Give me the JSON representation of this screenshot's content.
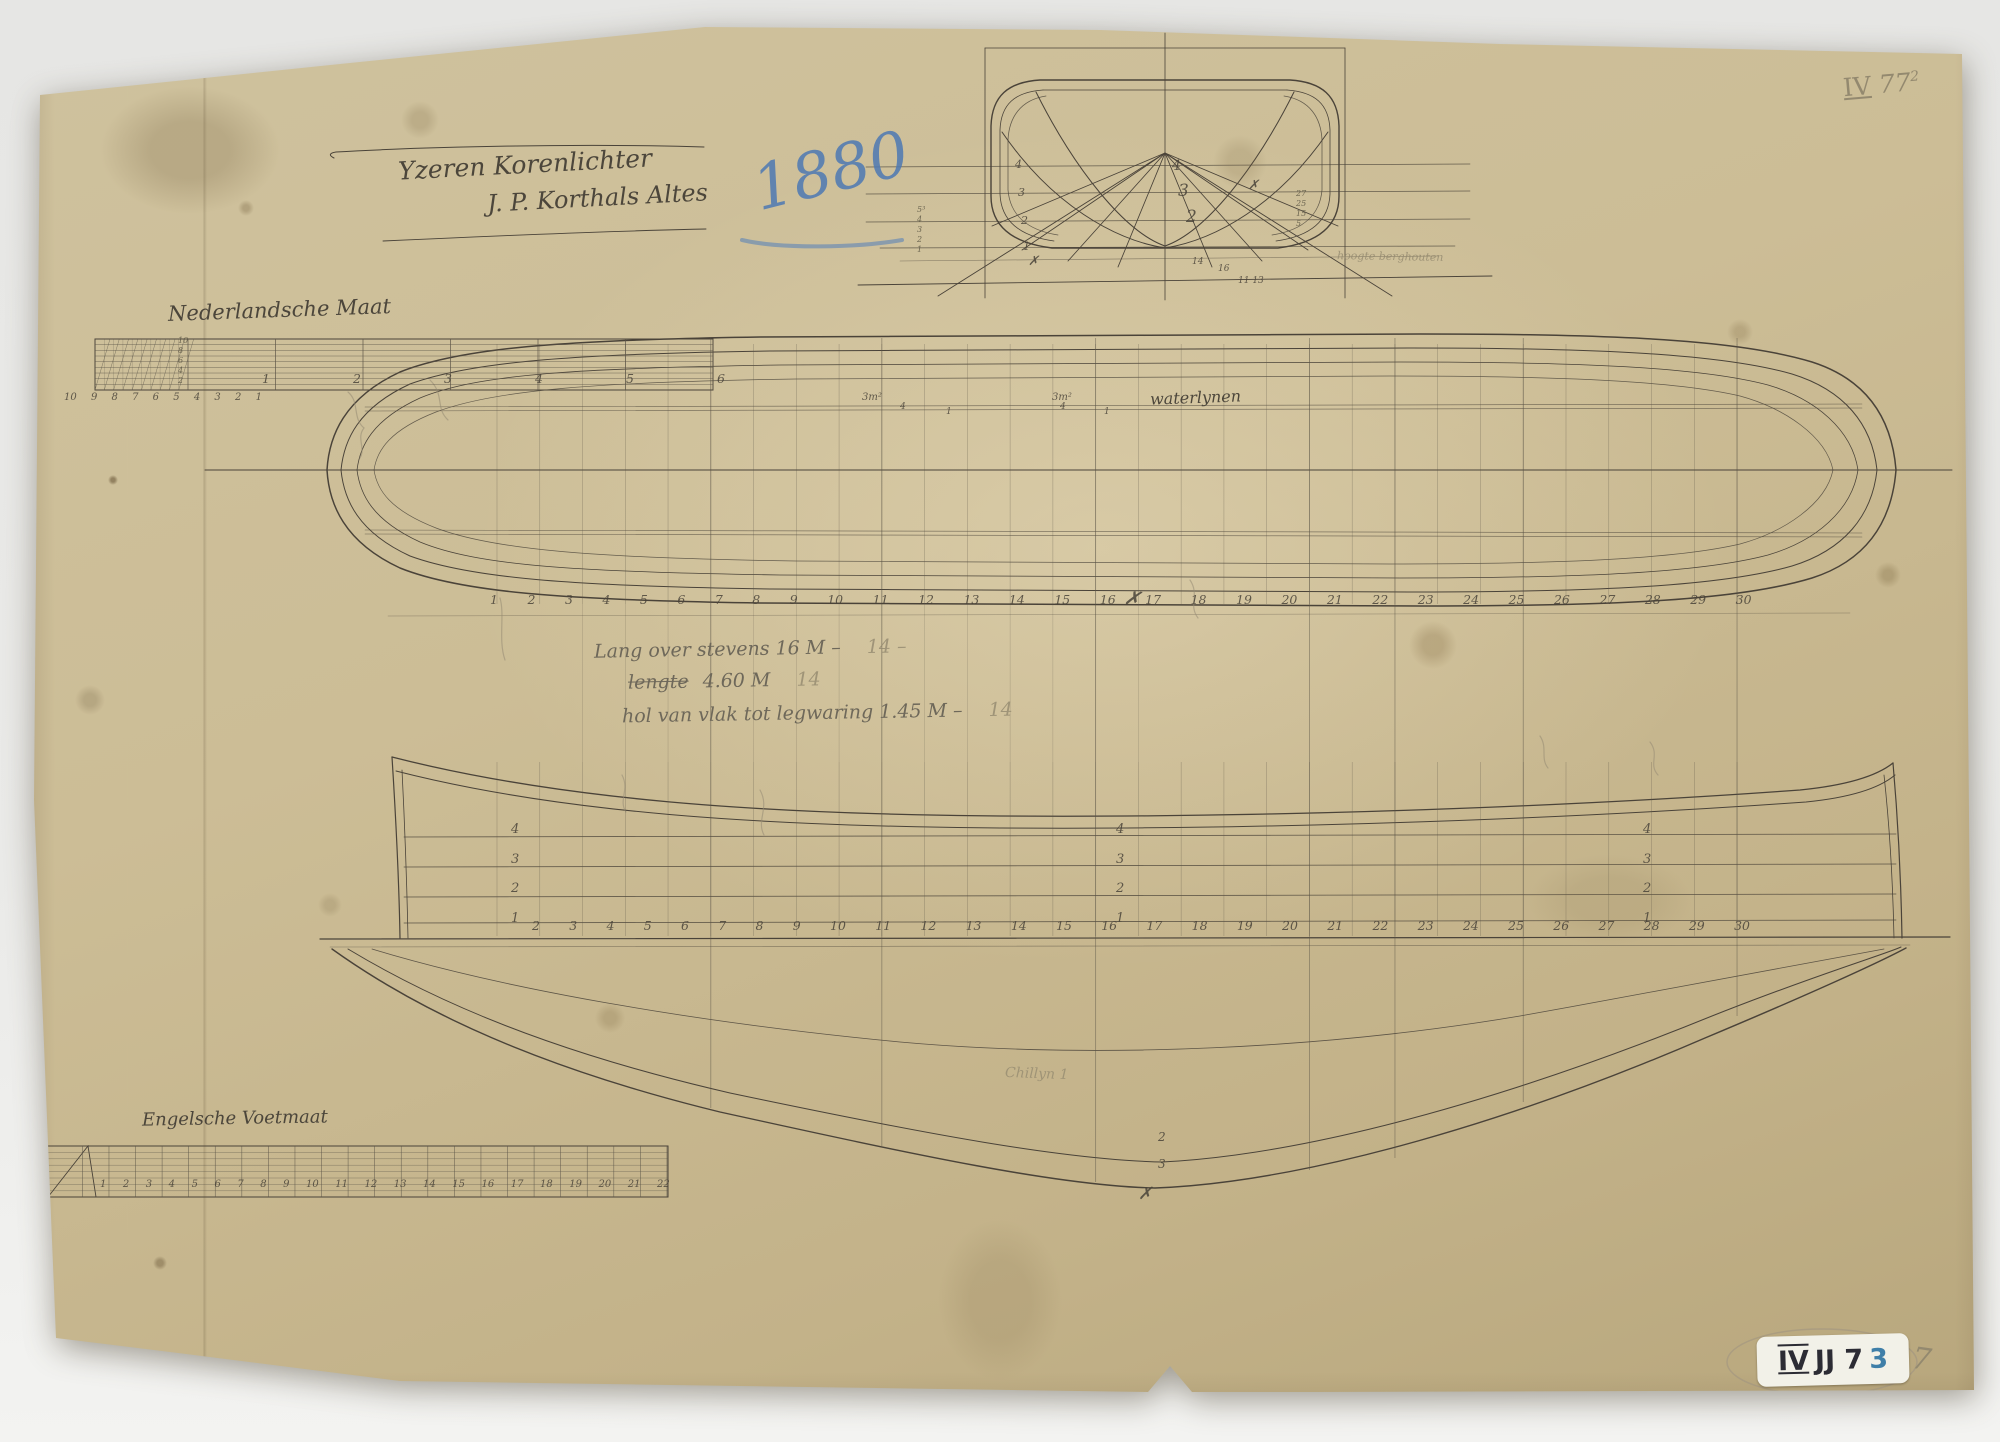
{
  "document": {
    "archive_mark": {
      "roman": "IV",
      "number": "77",
      "sup": "2"
    },
    "year_annotation": "1880",
    "title_line1": "Yzeren Korenlichter",
    "title_line2": "J. P. Korthals Altes",
    "specs": {
      "line1": "Lang over stevens 16 M –",
      "line1_pencil": "14 –",
      "line2_struck": "lengte",
      "line2": "4.60 M",
      "line2_pencil": "14",
      "line3": "hol van vlak tot legwaring 1.45 M –",
      "line3_pencil": "14"
    },
    "faint_note": "hoogte berghouten"
  },
  "scales": {
    "dutch": {
      "label": "Nederlandsche Maat",
      "minor_numbers": [
        "10",
        "9",
        "8",
        "7",
        "6",
        "5",
        "4",
        "3",
        "2",
        "1"
      ],
      "major_numbers": [
        "1",
        "2",
        "3",
        "4",
        "5",
        "6"
      ],
      "side_numbers": [
        "10",
        "8",
        "6",
        "4",
        "2"
      ]
    },
    "english": {
      "label": "Engelsche Voetmaat",
      "numbers": [
        "1",
        "2",
        "3",
        "4",
        "5",
        "6",
        "7",
        "8",
        "9",
        "10",
        "11",
        "12",
        "13",
        "14",
        "15",
        "16",
        "17",
        "18",
        "19",
        "20",
        "21",
        "22"
      ],
      "inch_numbers": [
        "2",
        "4",
        "6",
        "8",
        "10",
        "12"
      ]
    }
  },
  "plans": {
    "half_breadth": {
      "label": "waterlynen",
      "stations": [
        "1",
        "2",
        "3",
        "4",
        "5",
        "6",
        "7",
        "8",
        "9",
        "10",
        "11",
        "12",
        "13",
        "14",
        "15",
        "16",
        "17",
        "18",
        "19",
        "20",
        "21",
        "22",
        "23",
        "24",
        "25",
        "26",
        "27",
        "28",
        "29",
        "30"
      ]
    },
    "sheer": {
      "waterline_labels": [
        "4",
        "3",
        "2",
        "1"
      ],
      "stations": [
        "2",
        "3",
        "4",
        "5",
        "6",
        "7",
        "8",
        "9",
        "10",
        "11",
        "12",
        "13",
        "14",
        "15",
        "16",
        "17",
        "18",
        "19",
        "20",
        "21",
        "22",
        "23",
        "24",
        "25",
        "26",
        "27",
        "28",
        "29",
        "30"
      ],
      "chine_label": "Chillyn 1"
    },
    "body_plan": {
      "left_col_numbers": [
        "5³",
        "4",
        "3",
        "2",
        "1"
      ],
      "right_edge_numbers": [
        "27",
        "25",
        "15",
        "5"
      ]
    }
  },
  "annotations": [
    {
      "t": "3m²",
      "x": 862,
      "y": 392,
      "s": 10
    },
    {
      "t": "4",
      "x": 900,
      "y": 402,
      "s": 9
    },
    {
      "t": "1",
      "x": 946,
      "y": 407,
      "s": 9
    },
    {
      "t": "3m²",
      "x": 1052,
      "y": 392,
      "s": 10
    },
    {
      "t": "4",
      "x": 1060,
      "y": 402,
      "s": 9
    },
    {
      "t": "1",
      "x": 1104,
      "y": 407,
      "s": 9
    },
    {
      "t": "4",
      "x": 1015,
      "y": 158,
      "s": 11
    },
    {
      "t": "3",
      "x": 1018,
      "y": 186,
      "s": 11
    },
    {
      "t": "2",
      "x": 1021,
      "y": 214,
      "s": 11
    },
    {
      "t": "1",
      "x": 1023,
      "y": 240,
      "s": 11
    },
    {
      "t": "4",
      "x": 1172,
      "y": 158,
      "s": 14
    },
    {
      "t": "3",
      "x": 1178,
      "y": 181,
      "s": 17
    },
    {
      "t": "2",
      "x": 1186,
      "y": 207,
      "s": 17
    },
    {
      "t": "✗",
      "x": 1028,
      "y": 254,
      "s": 13
    },
    {
      "t": "✗",
      "x": 1248,
      "y": 178,
      "s": 13
    },
    {
      "t": "14",
      "x": 1192,
      "y": 257,
      "s": 9
    },
    {
      "t": "16",
      "x": 1218,
      "y": 264,
      "s": 9
    },
    {
      "t": "11 13",
      "x": 1238,
      "y": 276,
      "s": 9
    },
    {
      "t": "✗",
      "x": 1124,
      "y": 586,
      "s": 20,
      "r": 8
    },
    {
      "t": "2",
      "x": 1158,
      "y": 1130,
      "s": 12
    },
    {
      "t": "3",
      "x": 1158,
      "y": 1157,
      "s": 12
    },
    {
      "t": "✗",
      "x": 1138,
      "y": 1184,
      "s": 17
    }
  ],
  "stamp": {
    "prefix": "JJ 7",
    "roman": "IV",
    "accent_digit": "3",
    "pencil_digit": "7"
  }
}
